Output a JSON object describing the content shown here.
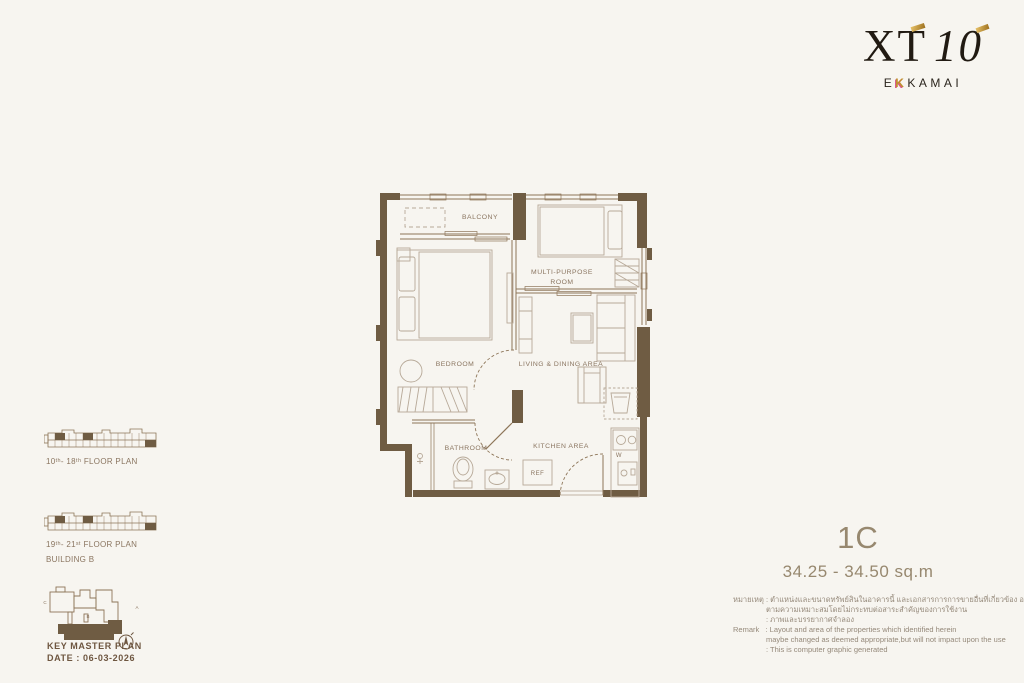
{
  "colors": {
    "background": "#f7f5f0",
    "wall_brown": "#6f5c43",
    "line_brown": "#8d7558",
    "furniture_line": "#b7a998",
    "label_text": "#8a7560",
    "unit_text": "#97886f",
    "logo_gold": "#c08f2e",
    "logo_pink": "#d8578a"
  },
  "logo": {
    "name": "XT",
    "number": "10",
    "sub_left": "E",
    "sub_k": "K",
    "sub_right": "KAMAI"
  },
  "floor_plan": {
    "labels": {
      "balcony": "BALCONY",
      "multi_purpose_1": "MULTI-PURPOSE",
      "multi_purpose_2": "ROOM",
      "bedroom": "BEDROOM",
      "living": "LIVING  & DINING AREA",
      "bathroom": "BATHROOM",
      "kitchen": "KITCHEN AREA",
      "ref": "REF",
      "washer": "W"
    }
  },
  "key_plans": {
    "plan_a_label": "10ᵗʰ- 18ᵗʰ  FLOOR PLAN",
    "plan_b_label": "19ᵗʰ- 21ˢᵗ  FLOOR PLAN",
    "building": "BUILDING B"
  },
  "master_plan": {
    "title": "KEY MASTER PLAN",
    "date": "DATE : 06-03-2026",
    "building_a": "A",
    "building_b": "B",
    "building_c": "C"
  },
  "unit": {
    "code": "1C",
    "area": "34.25 - 34.50 sq.m"
  },
  "remark": {
    "lines": [
      "หมายเหตุ : ตำแหน่งและขนาดทรัพย์สินในอาคารนี้ และเอกสารการการขายอื่นที่เกี่ยวข้อง อาจปรับเปลี่ยนได้",
      "ตามความเหมาะสมโดยไม่กระทบต่อสาระสำคัญของการใช้งาน",
      ": ภาพและบรรยากาศจำลอง",
      "Remark   : Layout and area of the properties which identified herein",
      "maybe changed as deemed appropriate,but will not impact upon the use",
      ": This is computer graphic generated"
    ]
  }
}
